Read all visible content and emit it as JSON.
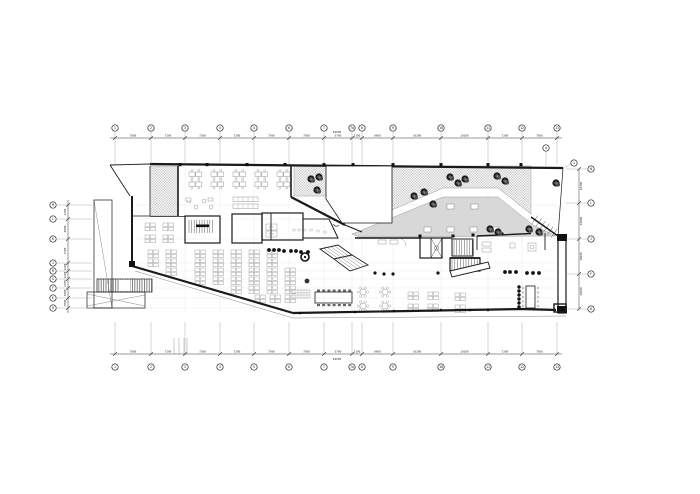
{
  "canvas": {
    "w": 700,
    "h": 494,
    "bg": "#ffffff"
  },
  "colors": {
    "wall": "#1a1a1a",
    "thin": "#555555",
    "faint_grid": "#ebebeb",
    "dim": "#333333",
    "furniture": "#999999",
    "deck_gray": "#d8d8d8",
    "checker": "#c9c9c9",
    "tree_dark": "#1b1b1b",
    "tree_mid": "#4a4a4a"
  },
  "grid": {
    "top": {
      "cy": 128,
      "dim_line_y": 138,
      "leader_end_y": 164,
      "bubbles": [
        {
          "x": 115,
          "label": "1"
        },
        {
          "x": 151,
          "label": "2"
        },
        {
          "x": 185,
          "label": "3"
        },
        {
          "x": 220,
          "label": "4"
        },
        {
          "x": 254,
          "label": "5"
        },
        {
          "x": 289,
          "label": "6"
        },
        {
          "x": 324,
          "label": "7"
        },
        {
          "x": 352,
          "label": "7a"
        },
        {
          "x": 362,
          "label": "8"
        },
        {
          "x": 393,
          "label": "9"
        },
        {
          "x": 441,
          "label": "10"
        },
        {
          "x": 488,
          "label": "11"
        },
        {
          "x": 522,
          "label": "12"
        },
        {
          "x": 557,
          "label": "13"
        }
      ],
      "segment_labels": [
        "7800",
        "7200",
        "7200",
        "7200",
        "7500",
        "7500",
        "5700",
        "2100",
        "6600",
        "10200",
        "10200",
        "7200",
        "7500"
      ],
      "total_label": "84000",
      "total_x": 337,
      "total_y": 133,
      "sub_bubble": {
        "x": 546,
        "y": 148,
        "label": "a"
      },
      "stub_bubble": {
        "x": 574,
        "y": 163,
        "label": "1"
      }
    },
    "bottom": {
      "cy": 367,
      "dim_line_y": 354,
      "leader_end_y": 322,
      "bubbles": [
        {
          "x": 115,
          "label": "1"
        },
        {
          "x": 151,
          "label": "2"
        },
        {
          "x": 185,
          "label": "3"
        },
        {
          "x": 220,
          "label": "4"
        },
        {
          "x": 254,
          "label": "5"
        },
        {
          "x": 289,
          "label": "6"
        },
        {
          "x": 324,
          "label": "7"
        },
        {
          "x": 352,
          "label": "7a"
        },
        {
          "x": 362,
          "label": "8"
        },
        {
          "x": 393,
          "label": "9"
        },
        {
          "x": 441,
          "label": "10"
        },
        {
          "x": 488,
          "label": "11"
        },
        {
          "x": 522,
          "label": "12"
        },
        {
          "x": 557,
          "label": "13"
        }
      ],
      "segment_labels": [
        "7800",
        "7200",
        "7200",
        "7200",
        "7500",
        "7500",
        "5700",
        "2100",
        "6600",
        "10200",
        "10200",
        "7200",
        "7500"
      ],
      "total_label": "84000",
      "total_x": 337,
      "total_y": 360,
      "extra_lines_x": [
        174,
        179,
        184,
        187
      ],
      "extra_lines_y1": 338,
      "extra_lines_y2": 354
    },
    "left": {
      "cx": 53,
      "dim_line_x": 68,
      "leader_x1": 56,
      "leader_x2": 92,
      "bubbles": [
        {
          "y": 205,
          "label": "M"
        },
        {
          "y": 219,
          "label": "L"
        },
        {
          "y": 239,
          "label": "K"
        },
        {
          "y": 263,
          "label": "J"
        },
        {
          "y": 271,
          "label": "H"
        },
        {
          "y": 279,
          "label": "G"
        },
        {
          "y": 288,
          "label": "F"
        },
        {
          "y": 298,
          "label": "E"
        },
        {
          "y": 308,
          "label": "D"
        }
      ],
      "segment_labels": [
        "4200",
        "6000",
        "7200",
        "2400",
        "2400",
        "2700",
        "3000",
        "3000"
      ]
    },
    "right": {
      "cx": 591,
      "dim_line_x": 579,
      "leader_x1": 566,
      "leader_x2": 587,
      "bubbles": [
        {
          "y": 169,
          "label": "N"
        },
        {
          "y": 203,
          "label": "L"
        },
        {
          "y": 239,
          "label": "J"
        },
        {
          "y": 274,
          "label": "F"
        },
        {
          "y": 309,
          "label": "D"
        }
      ],
      "segment_labels": [
        "10200",
        "10800",
        "10500",
        "10500"
      ]
    }
  },
  "plan": {
    "walls": [
      {
        "pts": [
          150,
          164,
          563,
          168
        ],
        "w": 2.2
      },
      {
        "pts": [
          110,
          165,
          150,
          164
        ],
        "w": 0.9
      },
      {
        "pts": [
          110,
          165,
          130,
          196
        ],
        "w": 0.9
      },
      {
        "pts": [
          132,
          196,
          132,
          266
        ],
        "w": 2.0
      },
      {
        "pts": [
          132,
          266,
          293,
          313
        ],
        "w": 2.2
      },
      {
        "pts": [
          293,
          313,
          522,
          309,
          556,
          310
        ],
        "w": 2.2
      },
      {
        "pts": [
          178,
          166,
          178,
          216
        ],
        "w": 1.6
      },
      {
        "pts": [
          291,
          166,
          291,
          197
        ],
        "w": 1.6
      },
      {
        "pts": [
          291,
          197,
          345,
          225
        ],
        "w": 2.2
      },
      {
        "pts": [
          345,
          225,
          362,
          232
        ],
        "w": 1.1
      },
      {
        "pts": [
          150,
          166,
          150,
          216
        ],
        "w": 0.7
      },
      {
        "pts": [
          132,
          216,
          150,
          216
        ],
        "w": 0.8
      },
      {
        "pts": [
          150,
          216.5,
          185,
          216.5
        ],
        "w": 0.8
      },
      {
        "pts": [
          355,
          238,
          420,
          238
        ],
        "w": 1.4
      },
      {
        "pts": [
          442,
          238,
          452,
          238
        ],
        "w": 1.4
      },
      {
        "pts": [
          477,
          236,
          531,
          233.5
        ],
        "w": 1.4
      },
      {
        "pts": [
          531,
          217,
          558,
          236
        ],
        "w": 1.5
      },
      {
        "pts": [
          563,
          168,
          558,
          236
        ],
        "w": 0.7
      },
      {
        "pts": [
          477,
          236,
          477,
          250
        ],
        "w": 0.9
      },
      {
        "pts": [
          545,
          233,
          545,
          250
        ],
        "w": 0.9
      },
      {
        "pts": [
          271,
          213,
          271,
          240
        ],
        "w": 0.9
      }
    ],
    "thin_lines": [
      {
        "pts": [
          135,
          271,
          293,
          318,
          566,
          316
        ],
        "w": 0.5
      },
      {
        "pts": [
          94,
          200,
          112,
          308
        ],
        "w": 0.5
      },
      {
        "pts": [
          87,
          294,
          145,
          306
        ],
        "w": 0.5
      },
      {
        "pts": [
          87,
          306,
          145,
          295
        ],
        "w": 0.5
      }
    ],
    "rooms": [
      {
        "x": 185,
        "y": 216,
        "w": 35,
        "h": 27,
        "sw": 1.2
      },
      {
        "x": 232,
        "y": 214,
        "w": 30,
        "h": 29,
        "sw": 1.2
      },
      {
        "x": 262,
        "y": 213,
        "w": 41,
        "h": 27,
        "sw": 1.2
      },
      {
        "x": 420,
        "y": 238,
        "w": 22,
        "h": 20,
        "sw": 1.2
      },
      {
        "x": 452,
        "y": 239,
        "w": 21,
        "h": 17,
        "sw": 1.0
      },
      {
        "x": 450,
        "y": 258,
        "w": 30,
        "h": 13,
        "sw": 1.2
      },
      {
        "x": 94,
        "y": 200,
        "w": 18,
        "h": 108,
        "sw": 0.7
      },
      {
        "x": 87,
        "y": 292,
        "w": 58,
        "h": 16,
        "sw": 0.7
      },
      {
        "x": 315,
        "y": 292,
        "w": 37,
        "h": 11,
        "sw": 0.8
      },
      {
        "x": 526,
        "y": 286,
        "w": 9,
        "h": 22,
        "sw": 0.8
      }
    ],
    "polys": [
      {
        "pts": [
          [
            303,
            219
          ],
          [
            329,
            219
          ],
          [
            338,
            238
          ],
          [
            303,
            238
          ]
        ],
        "sw": 1.0,
        "fill": "none"
      },
      {
        "pts": [
          [
            326,
            166
          ],
          [
            392,
            166
          ],
          [
            392,
            223
          ],
          [
            342,
            223
          ],
          [
            326,
            199
          ]
        ],
        "sw": 0.8,
        "fill": "#ffffff"
      },
      {
        "pts": [
          [
            450,
            271
          ],
          [
            488,
            262
          ],
          [
            490,
            268
          ],
          [
            452,
            277
          ]
        ],
        "sw": 0.9,
        "fill": "#ffffff"
      }
    ],
    "right_wall": {
      "x": 558,
      "y": 236,
      "w": 8,
      "h": 77
    },
    "terrace": {
      "checker_main": [
        [
          392,
          166
        ],
        [
          531,
          166
        ],
        [
          531,
          214
        ],
        [
          498,
          188
        ],
        [
          443,
          188
        ],
        [
          392,
          210
        ]
      ],
      "checker_left": [
        [
          294,
          166
        ],
        [
          326,
          166
        ],
        [
          326,
          196
        ],
        [
          294,
          196
        ]
      ],
      "checker_strip": {
        "x": 150,
        "y": 166,
        "w": 28,
        "h": 50
      },
      "deck": [
        [
          352,
          234
        ],
        [
          443,
          197
        ],
        [
          498,
          197
        ],
        [
          533,
          225
        ],
        [
          556,
          236
        ],
        [
          360,
          237
        ]
      ],
      "deck_squares": [
        [
          447,
          204
        ],
        [
          471,
          204
        ],
        [
          424,
          227
        ],
        [
          447,
          227
        ],
        [
          470,
          227
        ],
        [
          492,
          227
        ]
      ],
      "ramp_diag": {
        "x1": 531,
        "y1": 217,
        "x2": 558,
        "y2": 236,
        "n": 7,
        "len": 5
      }
    },
    "trees": [
      [
        311,
        179
      ],
      [
        319,
        177
      ],
      [
        317,
        190
      ],
      [
        414,
        196
      ],
      [
        424,
        192
      ],
      [
        433,
        204
      ],
      [
        450,
        177
      ],
      [
        458,
        183
      ],
      [
        465,
        179
      ],
      [
        497,
        176
      ],
      [
        505,
        181
      ],
      [
        490,
        229
      ],
      [
        498,
        232
      ],
      [
        529,
        229
      ],
      [
        539,
        232
      ],
      [
        556,
        183
      ]
    ],
    "top_desk_rows": {
      "ys": [
        172,
        182
      ],
      "xs": [
        189,
        211,
        233,
        255,
        277
      ]
    },
    "pods": [
      [
        148,
        250
      ],
      [
        166,
        250
      ],
      [
        195,
        250
      ],
      [
        213,
        250
      ],
      [
        231,
        250
      ],
      [
        249,
        250
      ],
      [
        267,
        250
      ],
      [
        148,
        259
      ],
      [
        166,
        259
      ],
      [
        195,
        259
      ],
      [
        213,
        259
      ],
      [
        231,
        259
      ],
      [
        249,
        259
      ],
      [
        267,
        259
      ],
      [
        166,
        268
      ],
      [
        195,
        268
      ],
      [
        213,
        268
      ],
      [
        231,
        268
      ],
      [
        249,
        268
      ],
      [
        267,
        268
      ],
      [
        285,
        268
      ],
      [
        195,
        277
      ],
      [
        213,
        277
      ],
      [
        231,
        277
      ],
      [
        249,
        277
      ],
      [
        267,
        277
      ],
      [
        285,
        277
      ],
      [
        231,
        286
      ],
      [
        249,
        286
      ],
      [
        267,
        286
      ],
      [
        285,
        286
      ],
      [
        255,
        295
      ],
      [
        270,
        295
      ],
      [
        285,
        295
      ],
      [
        145,
        223
      ],
      [
        163,
        223
      ],
      [
        145,
        235
      ],
      [
        163,
        235
      ],
      [
        408,
        292
      ],
      [
        428,
        292
      ],
      [
        408,
        304
      ],
      [
        428,
        304
      ],
      [
        455,
        293
      ],
      [
        455,
        305
      ]
    ],
    "flower_tables": [
      [
        363,
        292
      ],
      [
        385,
        292
      ],
      [
        363,
        306
      ],
      [
        385,
        306
      ]
    ],
    "lockers": [
      {
        "x": 233,
        "y": 197,
        "w": 25,
        "h": 4.5,
        "n": 5
      },
      {
        "x": 233,
        "y": 204,
        "w": 25,
        "h": 4.5,
        "n": 5
      },
      {
        "x": 292,
        "y": 290,
        "w": 18,
        "h": 3,
        "n": 6
      },
      {
        "x": 292,
        "y": 295,
        "w": 18,
        "h": 3,
        "n": 6
      }
    ],
    "lounge_circles": [
      [
        189,
        201
      ],
      [
        196,
        207
      ],
      [
        204,
        201
      ],
      [
        211,
        207
      ]
    ],
    "small_rects": [
      [
        186,
        198,
        5,
        3
      ],
      [
        208,
        198,
        5,
        3
      ],
      [
        378,
        240,
        8,
        4
      ],
      [
        390,
        240,
        8,
        4
      ],
      [
        482,
        242,
        9,
        4
      ],
      [
        482,
        248,
        9,
        4
      ],
      [
        510,
        243,
        5,
        5
      ],
      [
        528,
        243,
        8,
        8
      ]
    ],
    "dots": {
      "counter": [
        [
          269,
          250
        ],
        [
          274,
          250
        ],
        [
          279,
          250
        ],
        [
          284,
          251
        ],
        [
          291,
          251
        ],
        [
          296,
          251
        ],
        [
          301,
          252
        ],
        [
          308,
          252
        ]
      ],
      "mid": [
        [
          375,
          273
        ],
        [
          384,
          274
        ],
        [
          393,
          274
        ],
        [
          438,
          273
        ]
      ],
      "right_row": [
        [
          505,
          272
        ],
        [
          510,
          272
        ],
        [
          516,
          272
        ],
        [
          527,
          273
        ],
        [
          533,
          273
        ],
        [
          539,
          273
        ]
      ],
      "right_col": [
        [
          519,
          287
        ],
        [
          519,
          291
        ],
        [
          519,
          295
        ],
        [
          519,
          299
        ],
        [
          519,
          303
        ],
        [
          519,
          307
        ]
      ],
      "bottom": [
        [
          300,
          313
        ],
        [
          355,
          312
        ],
        [
          394,
          311
        ],
        [
          441,
          310
        ],
        [
          470,
          310
        ],
        [
          488,
          310
        ]
      ]
    },
    "wall_columns_top": [
      180,
      207,
      247,
      285,
      324,
      353,
      393,
      441,
      488,
      521
    ],
    "wall_columns_mid": [
      [
        420,
        236
      ],
      [
        453,
        236
      ],
      [
        473,
        235
      ],
      [
        502,
        234
      ]
    ],
    "rings": [
      [
        305,
        257
      ]
    ],
    "plant_blobs": [
      [
        307,
        281
      ]
    ],
    "ext_stair": {
      "x": 97,
      "y": 279,
      "w": 55,
      "h": 13,
      "gap_x": 119,
      "gap_w": 11
    },
    "escalator": {
      "quads": [
        [
          [
            320,
            249
          ],
          [
            338,
            245
          ],
          [
            352,
            255
          ],
          [
            334,
            259
          ]
        ],
        [
          [
            334,
            259
          ],
          [
            352,
            255
          ],
          [
            368,
            265
          ],
          [
            350,
            271
          ]
        ]
      ]
    },
    "conference_chairs": {
      "x0": 317,
      "step": 5.2,
      "n": 7,
      "y_top": 289.5,
      "y_bot": 304
    },
    "long_table_chairs": {
      "ys": [
        288,
        292.5,
        297,
        301.5,
        306
      ],
      "x_left": 523,
      "x_right": 538
    },
    "faint_grid": {
      "vxs": [
        185,
        220,
        254,
        289,
        324,
        352,
        362,
        393,
        441,
        488,
        522
      ],
      "v_y1": 166,
      "v_y2": 312,
      "hys": [
        205,
        219,
        239,
        263,
        271,
        279,
        288,
        298,
        308
      ],
      "h_x1": 135,
      "h_x2": 558
    }
  }
}
